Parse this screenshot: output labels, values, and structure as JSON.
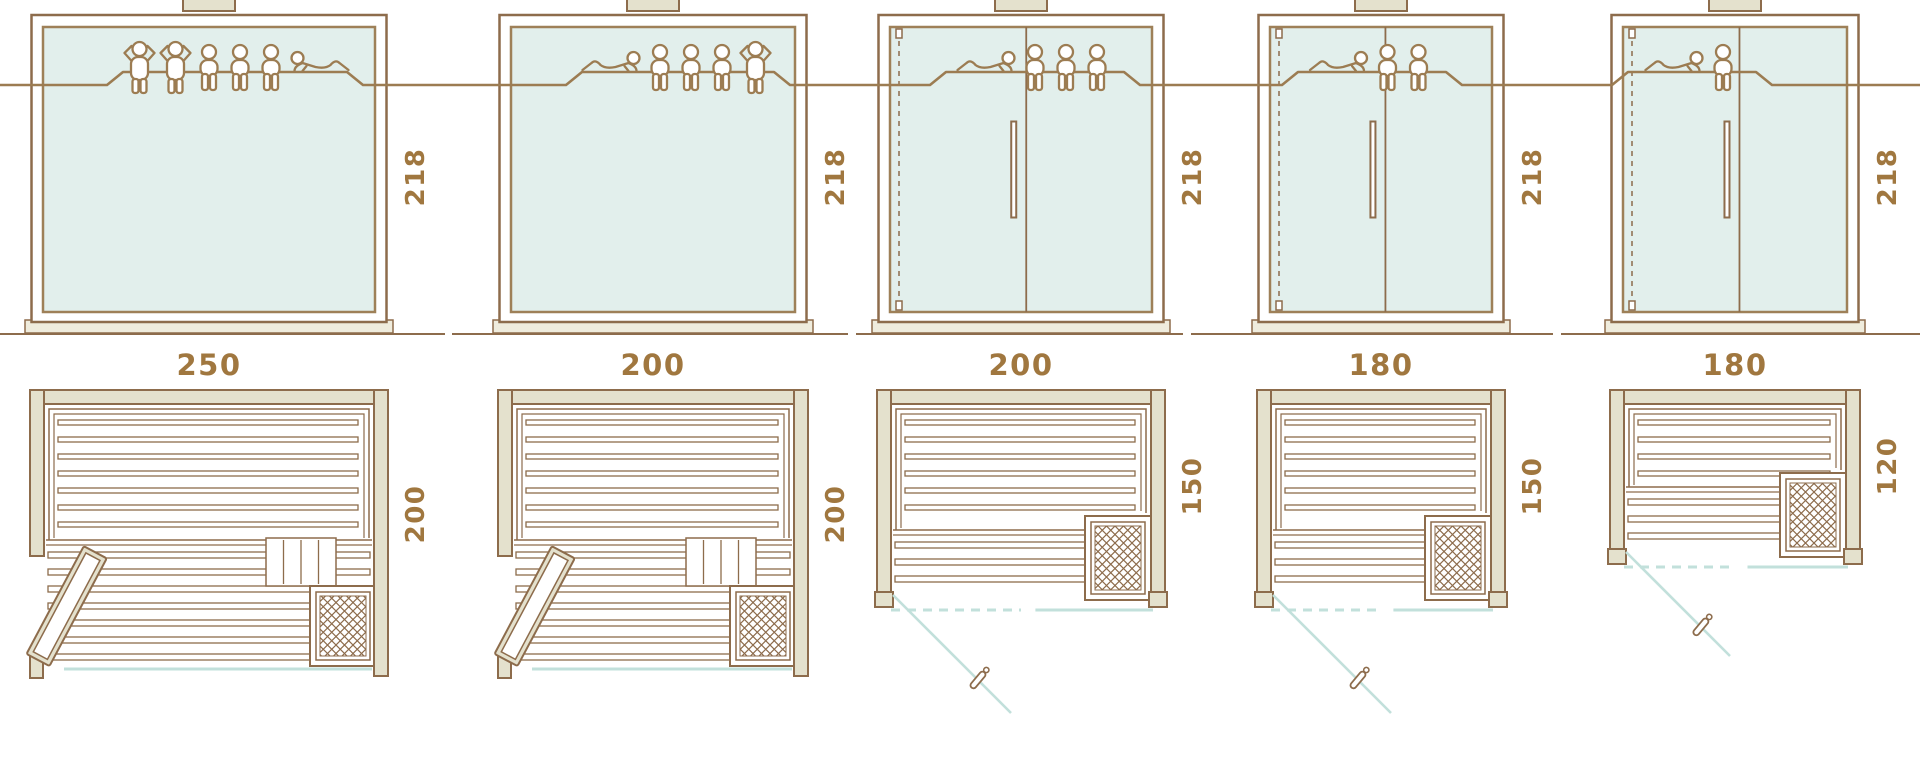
{
  "diagram": {
    "type": "sauna-size-comparison",
    "description": "Five sauna model variants: front glass elevation, floor plan and seating capacity figures",
    "columns": [
      {
        "model": "variant-250x200",
        "front": {
          "width_label": "250",
          "height_label": "218",
          "style": "fixed-glass-front"
        },
        "plan": {
          "depth_label": "200",
          "features": [
            "bench-slats",
            "heater",
            "open-hinged-door-left"
          ]
        },
        "capacity": {
          "persons": 6,
          "icons": [
            "standing-person",
            "standing-person",
            "seated-person",
            "seated-person",
            "seated-person",
            "reclining-person"
          ]
        }
      },
      {
        "model": "variant-200x200",
        "front": {
          "width_label": "200",
          "height_label": "218",
          "style": "fixed-glass-front"
        },
        "plan": {
          "depth_label": "200",
          "features": [
            "bench-slats",
            "heater",
            "open-hinged-door-left"
          ]
        },
        "capacity": {
          "persons": 5,
          "icons": [
            "reclining-person",
            "seated-person",
            "seated-person",
            "seated-person",
            "standing-person"
          ]
        }
      },
      {
        "model": "variant-200x150",
        "front": {
          "width_label": "200",
          "height_label": "218",
          "style": "hinged-door-with-fixed-panel"
        },
        "plan": {
          "depth_label": "150",
          "features": [
            "bench-slats",
            "heater",
            "door-swing"
          ]
        },
        "capacity": {
          "persons": 4,
          "icons": [
            "reclining-person",
            "seated-person",
            "seated-person",
            "seated-person"
          ]
        }
      },
      {
        "model": "variant-180x150",
        "front": {
          "width_label": "180",
          "height_label": "218",
          "style": "hinged-door-with-fixed-panel"
        },
        "plan": {
          "depth_label": "150",
          "features": [
            "bench-slats",
            "heater",
            "door-swing"
          ]
        },
        "capacity": {
          "persons": 3,
          "icons": [
            "reclining-person",
            "seated-person",
            "seated-person"
          ]
        }
      },
      {
        "model": "variant-180x120",
        "front": {
          "width_label": "180",
          "height_label": "218",
          "style": "hinged-door-with-fixed-panel"
        },
        "plan": {
          "depth_label": "120",
          "features": [
            "bench-slats",
            "heater",
            "door-swing"
          ]
        },
        "capacity": {
          "persons": 2,
          "icons": [
            "reclining-person",
            "seated-person"
          ]
        }
      }
    ],
    "colors": {
      "outline": "#8d6c4c",
      "glass_edge": "#9e8058",
      "dimension_text": "#a0773f",
      "wood_fill": "#e4e1cd",
      "sill_fill": "#efecdd",
      "glass_fill": "#e2efec",
      "glass_line": "#c2e0db",
      "people_line": "#9c7c52",
      "background": "#ffffff"
    }
  }
}
